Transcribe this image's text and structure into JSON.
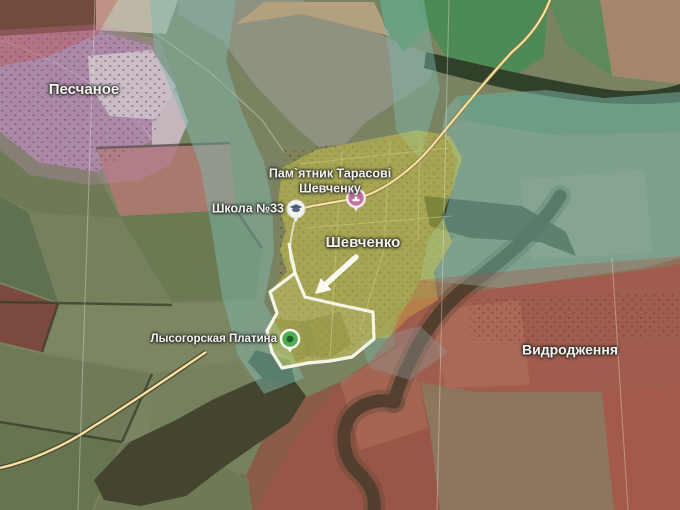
{
  "map": {
    "labels": {
      "peschanoye": "Песчаное",
      "monument": "Пам`ятник Тарасові\nШевченку",
      "school": "Школа №33",
      "shevchenko": "Шевченко",
      "dam": "Лысогорская Платина",
      "vidrodzhennya": "Видродження"
    },
    "markers": {
      "school": {
        "kind": "school",
        "icon": "graduation-cap-icon",
        "circle_color": "#f2f3ec",
        "icon_color": "#45607a"
      },
      "monument": {
        "kind": "monument",
        "icon": "monument-icon",
        "circle_color": "#c0739c",
        "icon_color": "#ffffff"
      },
      "dam": {
        "kind": "dam",
        "icon": "dam-icon",
        "circle_color": "#4caf50",
        "inner_color": "#1e5c22"
      }
    },
    "colors": {
      "contested_overlay": "#7fb7ac",
      "highlight_zone": "#d8d44a",
      "occupied_overlay": "#c04545",
      "settlement_overlay": "#c987c9",
      "advance_outline": "#fbfaf0",
      "road": "#f2e2a2"
    }
  }
}
